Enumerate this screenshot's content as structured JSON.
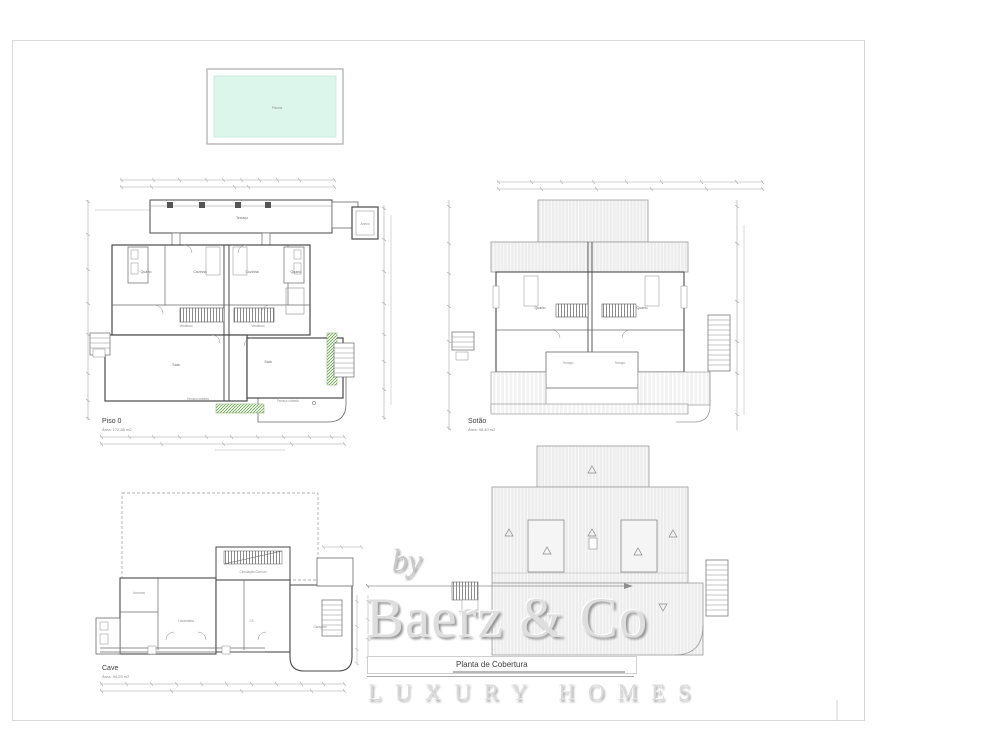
{
  "pool": {
    "label": "Piscina",
    "fill": "#dcf6ec",
    "border": "#b7b7b7"
  },
  "plans": {
    "piso0": {
      "title": "Piso 0",
      "area": "Área: 172,85 m2",
      "rooms": {
        "terraco": "Terraço",
        "quarto": "Quarto",
        "cozinha": "Cozinha",
        "sala": "Sala",
        "vestibulo": "Vestíbulo",
        "terraco_coberto": "Terraço coberto",
        "anexo": "Anexo"
      }
    },
    "sotao": {
      "title": "Sotão",
      "area": "Área: 98,40 m2",
      "rooms": {
        "quarto": "Quarto",
        "terraco": "Terraço"
      }
    },
    "cave": {
      "title": "Cave",
      "area": "Área: 94,25 m2",
      "rooms": {
        "circulacao": "Circulação Comum",
        "arrumos": "Arrumos",
        "lavandaria": "Lavandaria",
        "is": "I.S.",
        "garagem": "Garagem"
      }
    },
    "cobertura": {
      "title": "Planta de Cobertura"
    }
  },
  "watermark": {
    "by": "by",
    "brand": "Baerz & Co",
    "tagline": "LUXURY HOMES"
  },
  "colors": {
    "wall": "#4a4a4a",
    "fine": "#9b9b9b",
    "roof_fill": "#ececec",
    "green": "#69a84f"
  }
}
